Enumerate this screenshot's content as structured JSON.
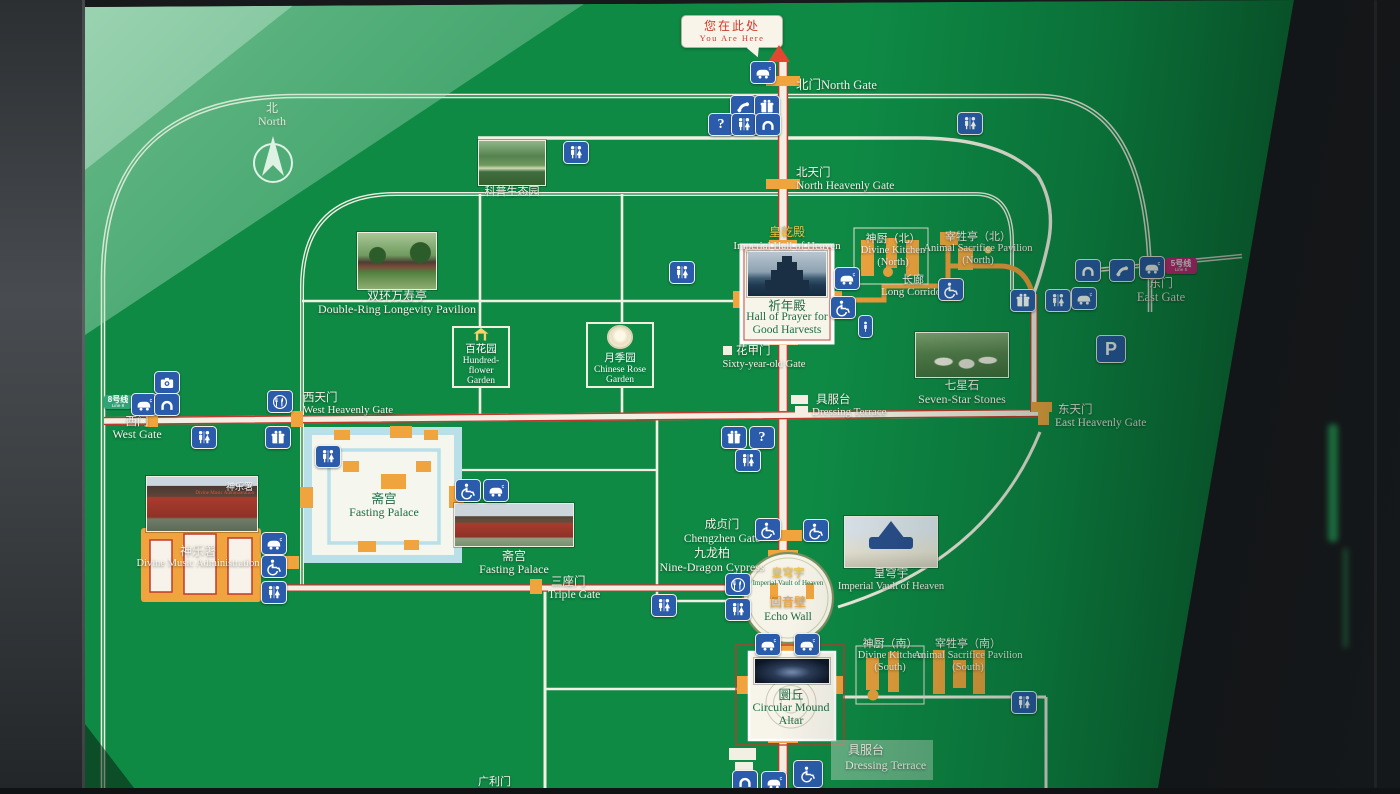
{
  "colors": {
    "board_green": "#0e8a45",
    "road_white": "#f3efe2",
    "axis_red": "#c0392e",
    "gate_orange": "#f0a43e",
    "icon_blue": "#2b5cab",
    "callout_red": "#d03a2c",
    "line5_pink": "#d9277f",
    "line8_green": "#2fa477",
    "moat_blue": "#b9dfe9"
  },
  "callout": {
    "zh": "您在此处",
    "en": "You Are Here"
  },
  "compass": {
    "zh": "北",
    "en": "North"
  },
  "badges": {
    "line5": "5号线",
    "line5_en": "Line 5",
    "line8": "8号线",
    "line8_en": "Line 8"
  },
  "glyphs": {
    "question": "?",
    "parking": "P"
  },
  "icon_legend": {
    "toilet-icon": "restrooms",
    "phone-icon": "public telephone",
    "gift-icon": "shop",
    "question-icon": "information",
    "arch-icon": "gate arch",
    "wheelchair-icon": "wheelchair accessible",
    "cart-icon": "sightseeing cart",
    "restaurant-icon": "restaurant",
    "parking-icon": "parking",
    "camera-icon": "photo service",
    "person-icon": "person"
  },
  "labels": {
    "north_gate": {
      "zh": "北门",
      "en": "North Gate"
    },
    "north_heavenly_gate": {
      "zh": "北天门",
      "en": "North Heavenly Gate"
    },
    "science_garden": {
      "zh": "科普生态园"
    },
    "double_ring_pavilion": {
      "zh": "双环万寿亭",
      "en": "Double-Ring Longevity Pavilion"
    },
    "imperial_hall_of_heaven": {
      "zh": "皇乾殿",
      "en": "Imperial Hall of Heaven"
    },
    "hall_of_prayer": {
      "zh": "祈年殿",
      "en": "Hall of Prayer for Good Harvests"
    },
    "divine_kitchen_north": {
      "zh": "神厨（北）",
      "en": "Divine Kitchen (North)"
    },
    "animal_sacrifice_north": {
      "zh": "宰牲亭（北）",
      "en": "Animal Sacrifice Pavilion (North)"
    },
    "long_corridor": {
      "zh": "长廊",
      "en": "Long Corridor"
    },
    "east_gate": {
      "zh": "东门",
      "en": "East Gate"
    },
    "hundred_flower_garden": {
      "zh": "百花园",
      "en": "Hundred-flower Garden"
    },
    "chinese_rose_garden": {
      "zh": "月季园",
      "en": "Chinese Rose Garden"
    },
    "sixty_year_old_gate": {
      "zh": "花甲门",
      "en": "Sixty-year-old Gate"
    },
    "seven_star_stones": {
      "zh": "七星石",
      "en": "Seven-Star Stones"
    },
    "dressing_terrace": {
      "zh": "具服台",
      "en": "Dressing Terrace"
    },
    "west_heavenly_gate": {
      "zh": "西天门",
      "en": "West Heavenly Gate"
    },
    "west_gate": {
      "zh": "西门",
      "en": "West Gate"
    },
    "fasting_palace": {
      "zh": "斋宫",
      "en": "Fasting Palace"
    },
    "divine_music_administration": {
      "zh": "神乐署",
      "en": "Divine Music Administration"
    },
    "chengzhen_gate": {
      "zh": "成贞门",
      "en": "Chengzhen Gate"
    },
    "nine_dragon_cypress": {
      "zh": "九龙柏",
      "en": "Nine-Dragon Cypress"
    },
    "imperial_vault": {
      "zh": "皇穹宇",
      "en": "Imperial Vault of Heaven"
    },
    "echo_wall": {
      "zh": "回音壁",
      "en": "Echo Wall"
    },
    "east_heavenly_gate": {
      "zh": "东天门",
      "en": "East Heavenly Gate"
    },
    "triple_gate": {
      "zh": "三座门",
      "en": "Triple Gate"
    },
    "divine_kitchen_south": {
      "zh": "神厨（南）",
      "en": "Divine Kitchen (South)"
    },
    "animal_sacrifice_south": {
      "zh": "宰牲亭（南）",
      "en": "Animal Sacrifice Pavilion (South)"
    },
    "circular_mound_altar": {
      "zh": "圜丘",
      "en": "Circular Mound Altar"
    },
    "guangli_gate": {
      "zh": "广利门"
    }
  }
}
